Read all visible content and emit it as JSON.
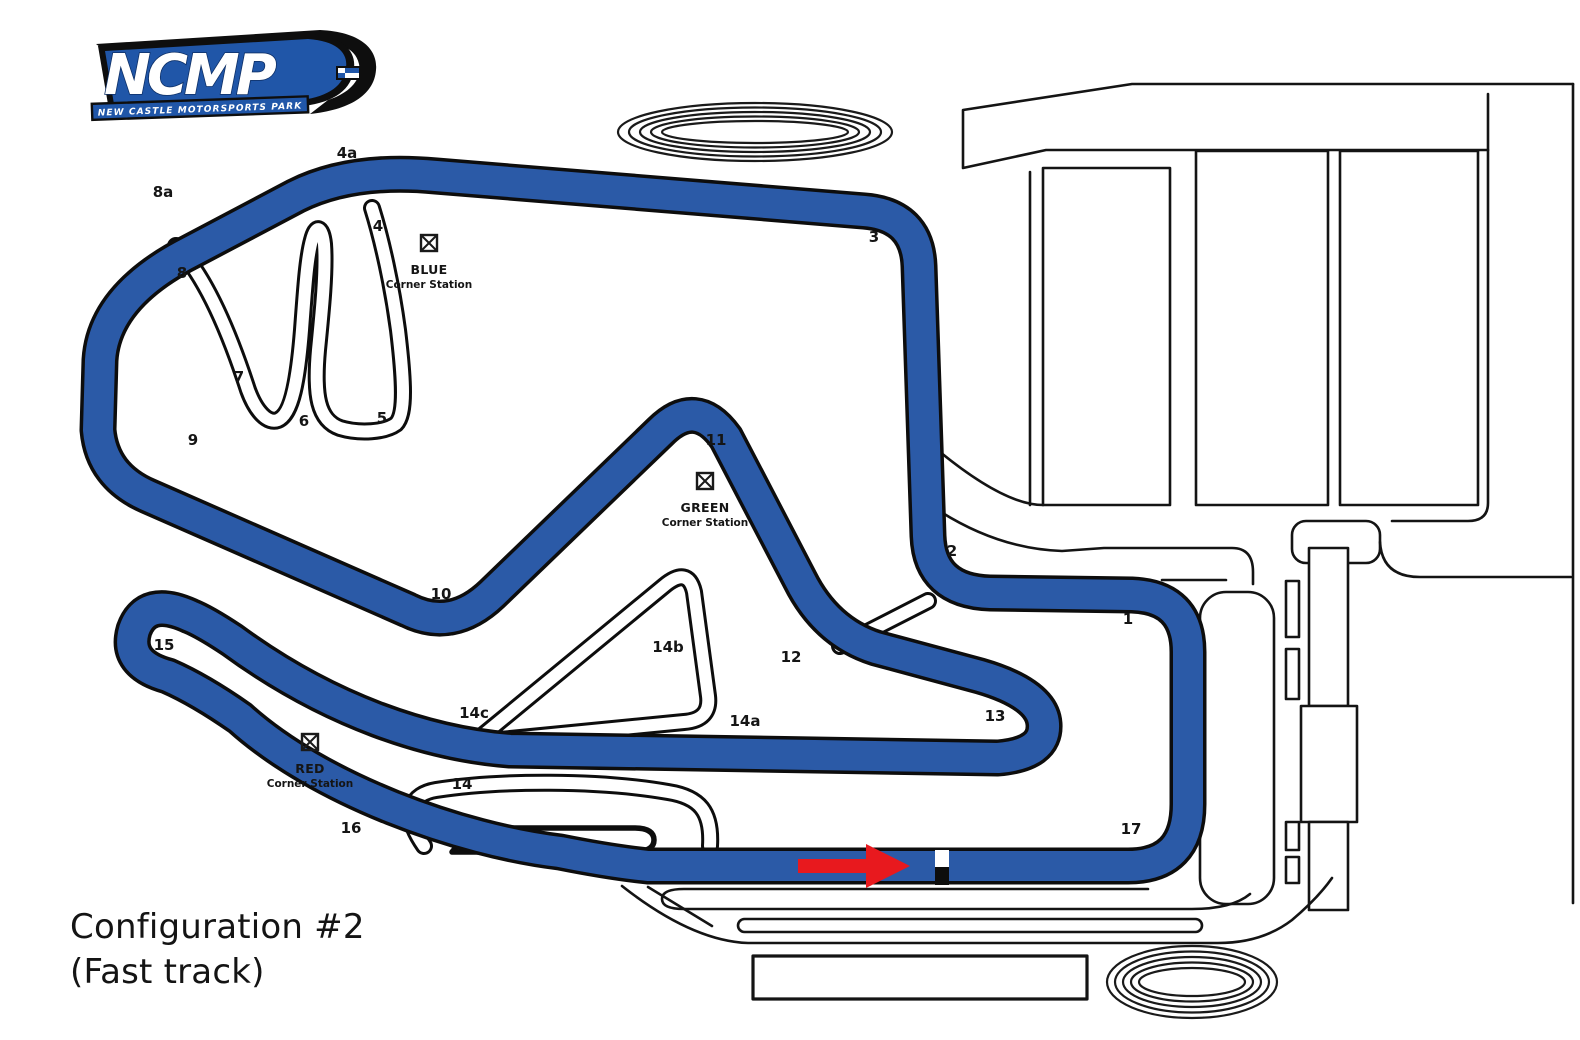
{
  "logo": {
    "acronym": "NCMP",
    "subtitle": "NEW CASTLE MOTORSPORTS PARK"
  },
  "title": {
    "line1": "Configuration #2",
    "line2": "(Fast track)"
  },
  "colors": {
    "track_blue": "#2b5aa7",
    "outline_black": "#0d0d0d",
    "arrow_red": "#e8191e",
    "background": "#ffffff",
    "logo_blue": "#2056a8"
  },
  "track": {
    "configuration": "Configuration #2",
    "nickname": "(Fast track)",
    "direction_indicator": "red-arrow-pointing-right-at-start-finish",
    "turn_labels": [
      {
        "t": "4a",
        "x": 347,
        "y": 158
      },
      {
        "t": "8a",
        "x": 163,
        "y": 197
      },
      {
        "t": "4",
        "x": 378,
        "y": 231
      },
      {
        "t": "3",
        "x": 874,
        "y": 242
      },
      {
        "t": "8",
        "x": 182,
        "y": 278
      },
      {
        "t": "7",
        "x": 239,
        "y": 382
      },
      {
        "t": "6",
        "x": 304,
        "y": 426
      },
      {
        "t": "5",
        "x": 382,
        "y": 423
      },
      {
        "t": "9",
        "x": 193,
        "y": 445
      },
      {
        "t": "11",
        "x": 716,
        "y": 445
      },
      {
        "t": "10",
        "x": 441,
        "y": 599
      },
      {
        "t": "2",
        "x": 952,
        "y": 556
      },
      {
        "t": "1",
        "x": 1128,
        "y": 624
      },
      {
        "t": "15",
        "x": 164,
        "y": 650
      },
      {
        "t": "14b",
        "x": 668,
        "y": 652
      },
      {
        "t": "12",
        "x": 791,
        "y": 662
      },
      {
        "t": "14c",
        "x": 474,
        "y": 718
      },
      {
        "t": "14a",
        "x": 745,
        "y": 726
      },
      {
        "t": "13",
        "x": 995,
        "y": 721
      },
      {
        "t": "14",
        "x": 462,
        "y": 789
      },
      {
        "t": "16",
        "x": 351,
        "y": 833
      },
      {
        "t": "17",
        "x": 1131,
        "y": 834
      }
    ],
    "corner_stations": [
      {
        "name": "BLUE",
        "sub": "Corner Station",
        "x": 429,
        "y": 243
      },
      {
        "name": "GREEN",
        "sub": "Corner Station",
        "x": 705,
        "y": 481
      },
      {
        "name": "RED",
        "sub": "Corner Station",
        "x": 310,
        "y": 742
      }
    ]
  }
}
